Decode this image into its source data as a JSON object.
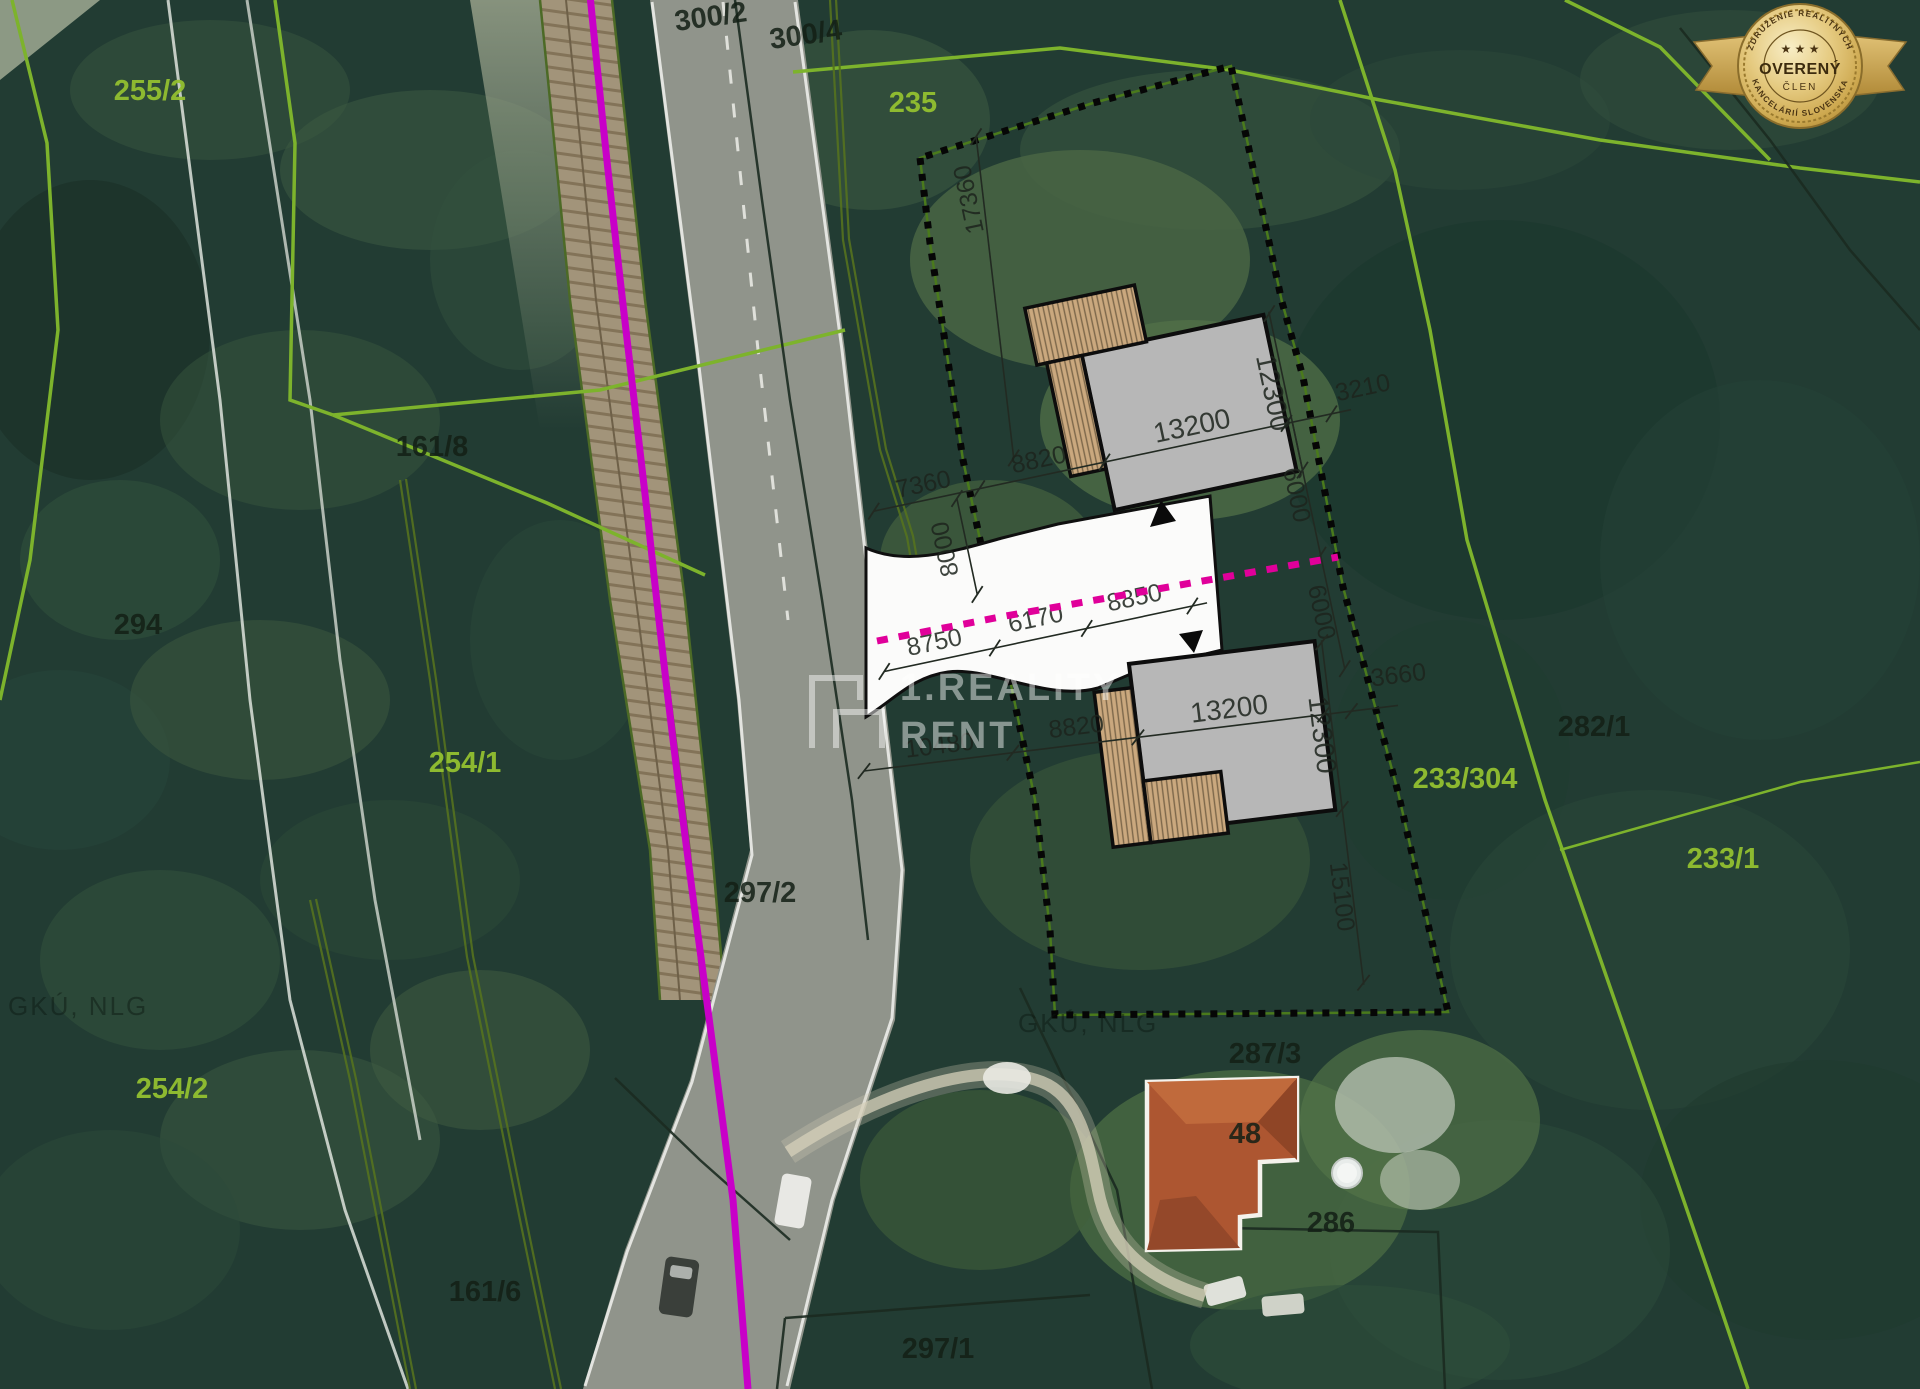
{
  "badge": {
    "top_arc": "ZDRUŽENIE REALITNÝCH",
    "stars": "★ ★ ★",
    "title": "OVERENÝ",
    "subtitle": "ČLEN",
    "bottom_arc": "KANCELÁRIÍ SLOVENSKA"
  },
  "watermark": {
    "brand_line1": "1.REALITY",
    "brand_line2": "RENT",
    "map_source_left": "GKÚ, NLG",
    "map_source_center": "GKÚ, NLG"
  },
  "parcels": [
    {
      "label": "255/2"
    },
    {
      "label": "300/2"
    },
    {
      "label": "300/4"
    },
    {
      "label": "235"
    },
    {
      "label": "161/8"
    },
    {
      "label": "294"
    },
    {
      "label": "254/1"
    },
    {
      "label": "297/2"
    },
    {
      "label": "254/2"
    },
    {
      "label": "161/6"
    },
    {
      "label": "297/1"
    },
    {
      "label": "287/3"
    },
    {
      "label": "48"
    },
    {
      "label": "286"
    },
    {
      "label": "282/1"
    },
    {
      "label": "233/304"
    },
    {
      "label": "233/1"
    }
  ],
  "dims": {
    "upper": {
      "frontage": "7360",
      "gap": "8820",
      "house_width": "13200",
      "offset_right": "3210",
      "house_depth": "12300",
      "boundary_top": "17360",
      "road_width": "8000",
      "south_a": "6000",
      "south_b": "6000"
    },
    "access": {
      "a": "8750",
      "b": "6170",
      "c": "8850"
    },
    "lower": {
      "frontage": "10480",
      "gap": "8820",
      "house_width": "13200",
      "house_depth": "12300",
      "south": "15100",
      "offset_right": "3660"
    }
  },
  "colors": {
    "railway_magenta": "#c800c8",
    "boundary_magenta": "#e0009a",
    "parcel_green": "#93c030",
    "building_gray": "#b7b7b7",
    "terrace_tan": "#caa87e",
    "badge_gold": "#d4af5a"
  }
}
